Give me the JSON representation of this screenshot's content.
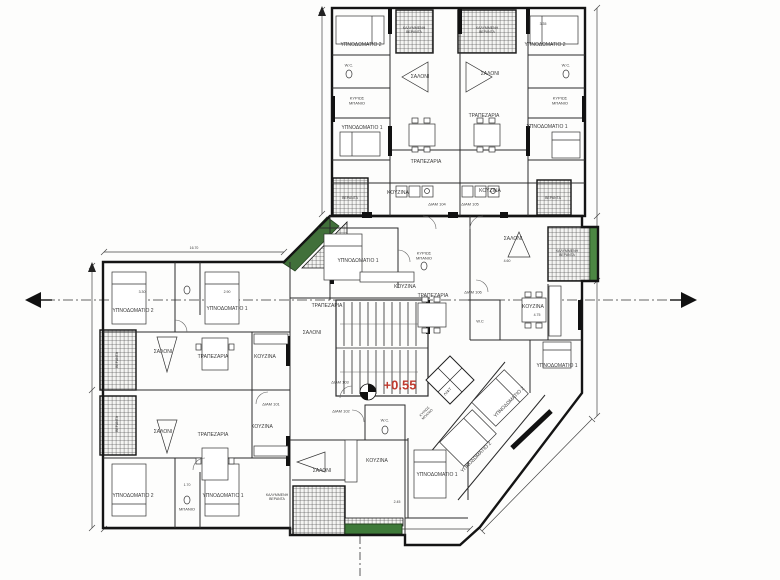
{
  "page": {
    "background": "#fdfdfc",
    "type": "architectural-floor-plan"
  },
  "colors": {
    "wall": "#1a1a1a",
    "line": "#2e2e2e",
    "hatch": "#4a4a4a",
    "dim": "#444444",
    "green_ramp": "#41703a",
    "green_strip": "#4c8743",
    "green_planter": "#3e7a39",
    "level_red": "#bf3b2f"
  },
  "plan": {
    "level_label": "+0.55",
    "apartments": [
      "ΔΙΑΜ 101",
      "ΔΙΑΜ 102",
      "ΔΙΑΜ 103",
      "ΔΙΑΜ 104",
      "ΔΙΑΜ 105",
      "ΔΙΑΜ 106"
    ],
    "labels": [
      {
        "t": "ΥΠΝΟΔΩΜΑΤΙΟ 2",
        "x": 361,
        "y": 46
      },
      {
        "t": "W.C.",
        "x": 349,
        "y": 66,
        "s": 4
      },
      {
        "t": "ΚΥΡΙΩΣ\nΜΠΑΝΙΟ",
        "x": 357,
        "y": 101,
        "s": 4
      },
      {
        "t": "ΥΠΝΟΔΩΜΑΤΙΟ 1",
        "x": 362,
        "y": 129
      },
      {
        "t": "ΚΑΛΥΜΜΕΝΗ\nΒΕΡΑΝΤΑ",
        "x": 414,
        "y": 30,
        "s": 3.5,
        "n": "veranda-label"
      },
      {
        "t": "ΚΑΛΥΜΜΕΝΗ\nΒΕΡΑΝΤΑ",
        "x": 487,
        "y": 30,
        "s": 3.5,
        "n": "veranda-label"
      },
      {
        "t": "ΣΑΛΟΝΙ",
        "x": 420,
        "y": 78
      },
      {
        "t": "ΣΑΛΟΝΙ",
        "x": 490,
        "y": 75
      },
      {
        "t": "ΤΡΑΠΕΖΑΡΙΑ",
        "x": 426,
        "y": 163
      },
      {
        "t": "ΤΡΑΠΕΖΑΡΙΑ",
        "x": 484,
        "y": 117
      },
      {
        "t": "ΚΟΥΖΙΝΑ",
        "x": 398,
        "y": 194
      },
      {
        "t": "ΚΟΥΖΙΝΑ",
        "x": 490,
        "y": 192
      },
      {
        "t": "ΥΠΝΟΔΩΜΑΤΙΟ 2",
        "x": 545,
        "y": 46
      },
      {
        "t": "ΥΠΝΟΔΩΜΑΤΙΟ 1",
        "x": 547,
        "y": 128
      },
      {
        "t": "W.C.",
        "x": 566,
        "y": 66,
        "s": 4
      },
      {
        "t": "ΚΥΡΙΩΣ\nΜΠΑΝΙΟ",
        "x": 560,
        "y": 101,
        "s": 4
      },
      {
        "t": "ΒΕΡΑΝΤΑ",
        "x": 350,
        "y": 198,
        "s": 3.5,
        "n": "veranda-label"
      },
      {
        "t": "ΒΕΡΑΝΤΑ",
        "x": 553,
        "y": 198,
        "s": 3.5,
        "n": "veranda-label"
      },
      {
        "t": "ΔΙΑΜ 104",
        "x": 437,
        "y": 205,
        "s": 4,
        "n": "apartment-label"
      },
      {
        "t": "ΔΙΑΜ 105",
        "x": 470,
        "y": 205,
        "s": 4,
        "n": "apartment-label"
      },
      {
        "t": "ΥΠΝΟΔΩΜΑΤΙΟ 1",
        "x": 358,
        "y": 262
      },
      {
        "t": "ΚΥΡΙΩΣ\nΜΠΑΝΙΟ",
        "x": 424,
        "y": 256,
        "s": 4
      },
      {
        "t": "ΚΟΥΖΙΝΑ",
        "x": 405,
        "y": 288
      },
      {
        "t": "ΤΡΑΠΕΖΑΡΙΑ",
        "x": 327,
        "y": 307
      },
      {
        "t": "ΣΑΛΟΝΙ",
        "x": 312,
        "y": 334
      },
      {
        "t": "ΣΑΛΟΝΙ",
        "x": 513,
        "y": 240
      },
      {
        "t": "4.60",
        "x": 507,
        "y": 261,
        "s": 3.5,
        "n": "dimension-label"
      },
      {
        "t": "ΤΡΑΠΕΖΑΡΙΑ",
        "x": 433,
        "y": 297
      },
      {
        "t": "ΚΟΥΖΙΝΑ",
        "x": 533,
        "y": 308
      },
      {
        "t": "4.75",
        "x": 537,
        "y": 315,
        "s": 3.5,
        "n": "dimension-label"
      },
      {
        "t": "W.C",
        "x": 480,
        "y": 322,
        "s": 4
      },
      {
        "t": "ΔΙΑΜ 106",
        "x": 473,
        "y": 293,
        "s": 4,
        "n": "apartment-label"
      },
      {
        "t": "ΚΑΛΥΜΜΕΝΗ\nΒΕΡΑΝΤΑ",
        "x": 567,
        "y": 253,
        "s": 3.5,
        "n": "veranda-label"
      },
      {
        "t": "ΥΠΝΟΔΩΜΑΤΙΟ 2",
        "x": 133,
        "y": 312
      },
      {
        "t": "ΥΠΝΟΔΩΜΑΤΙΟ 1",
        "x": 227,
        "y": 310
      },
      {
        "t": "3.30",
        "x": 142,
        "y": 292,
        "s": 3.5,
        "n": "dimension-label"
      },
      {
        "t": "2.90",
        "x": 227,
        "y": 292,
        "s": 3.5,
        "n": "dimension-label"
      },
      {
        "t": "ΣΑΛΟΝΙ",
        "x": 163,
        "y": 353
      },
      {
        "t": "ΤΡΑΠΕΖΑΡΙΑ",
        "x": 213,
        "y": 358
      },
      {
        "t": "ΚΟΥΖΙΝΑ",
        "x": 265,
        "y": 358
      },
      {
        "t": "ΔΙΑΜ 101",
        "x": 271,
        "y": 405,
        "s": 4,
        "n": "apartment-label"
      },
      {
        "t": "ΣΑΛΟΝΙ",
        "x": 163,
        "y": 433
      },
      {
        "t": "ΤΡΑΠΕΖΑΡΙΑ",
        "x": 213,
        "y": 436
      },
      {
        "t": "ΚΟΥΖΙΝΑ",
        "x": 262,
        "y": 428
      },
      {
        "t": "ΥΠΝΟΔΩΜΑΤΙΟ 2",
        "x": 133,
        "y": 497
      },
      {
        "t": "ΥΠΝΟΔΩΜΑΤΙΟ 1",
        "x": 223,
        "y": 497
      },
      {
        "t": "1.70",
        "x": 187,
        "y": 485,
        "s": 3.5,
        "n": "dimension-label"
      },
      {
        "t": "ΜΠΑΝΙΟ",
        "x": 187,
        "y": 510,
        "s": 4
      },
      {
        "t": "ΒΕΡΑΝΤΑ",
        "x": 117,
        "y": 360,
        "s": 3.5,
        "r": -90,
        "n": "veranda-label"
      },
      {
        "t": "ΒΕΡΑΝΤΑ",
        "x": 117,
        "y": 424,
        "s": 3.5,
        "r": -90,
        "n": "veranda-label"
      },
      {
        "t": "ΔΙΑΜ 103",
        "x": 340,
        "y": 383,
        "s": 4,
        "n": "apartment-label"
      },
      {
        "t": "ΔΙΑΜ 102",
        "x": 341,
        "y": 412,
        "s": 4,
        "n": "apartment-label"
      },
      {
        "t": "+0.55",
        "x": 400,
        "y": 386,
        "s": 13,
        "b": true,
        "c": "#bf3b2f",
        "n": "level-label"
      },
      {
        "t": "W.C.",
        "x": 385,
        "y": 421,
        "s": 4
      },
      {
        "t": "ΚΟΥΖΙΝΑ",
        "x": 377,
        "y": 462
      },
      {
        "t": "2.45",
        "x": 397,
        "y": 502,
        "s": 3.5,
        "n": "dimension-label"
      },
      {
        "t": "ΣΑΛΟΝΙ",
        "x": 322,
        "y": 472
      },
      {
        "t": "ΚΑΛΥΜΜΕΝΗ\nΒΕΡΑΝΤΑ",
        "x": 277,
        "y": 497,
        "s": 3.5,
        "n": "veranda-label"
      },
      {
        "t": "ΥΠΝΟΔΩΜΑΤΙΟ 1",
        "x": 437,
        "y": 476
      },
      {
        "t": "ΥΠΝΟΔΩΜΑΤΙΟ 2",
        "x": 477,
        "y": 458,
        "r": -45
      },
      {
        "t": "ΥΠΝΟΔΩΜΑΤΙΟ 2",
        "x": 510,
        "y": 403,
        "r": -45
      },
      {
        "t": "ΥΠΝΟΔΩΜΑΤΙΟ 1",
        "x": 557,
        "y": 367
      },
      {
        "t": "ΛΙΦΤ",
        "x": 448,
        "y": 392,
        "s": 4,
        "r": -45
      },
      {
        "t": "ΚΥΡΙΩΣ\nΜΠΑΝΙΟ",
        "x": 426,
        "y": 413,
        "s": 3.5,
        "r": -45
      },
      {
        "t": "3.35",
        "x": 543,
        "y": 24,
        "s": 3.5,
        "n": "dimension-label"
      },
      {
        "t": "16.70",
        "x": 194,
        "y": 248,
        "s": 3.5,
        "n": "dimension-label"
      }
    ]
  }
}
